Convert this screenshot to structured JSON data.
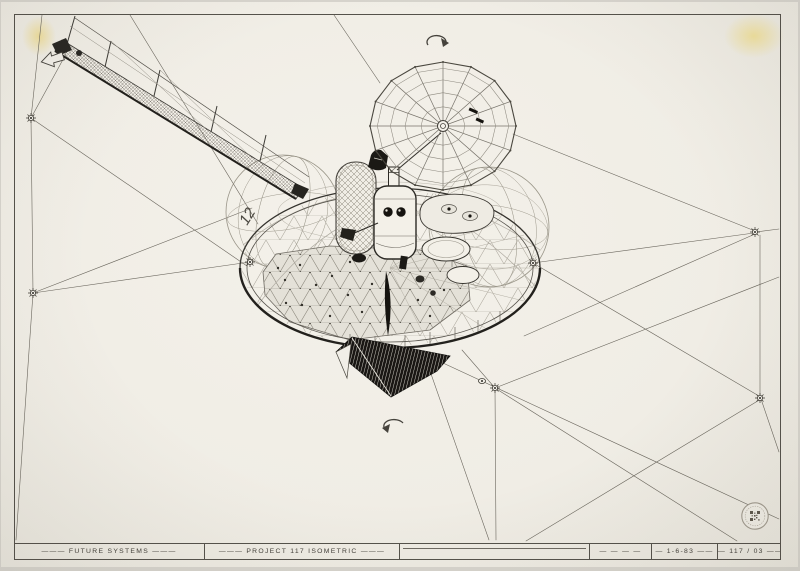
{
  "sheet": {
    "labels": {
      "sphere_marking": "12"
    },
    "title_block": {
      "cells": [
        {
          "id": "firm",
          "label": "——— FUTURE SYSTEMS ———"
        },
        {
          "id": "title",
          "label": "——— PROJECT 117  ISOMETRIC ———"
        },
        {
          "id": "blank",
          "label": ""
        },
        {
          "id": "dashes",
          "label": "— — — —"
        },
        {
          "id": "date",
          "label": "— 1-6-83 ——"
        },
        {
          "id": "number",
          "label": "— 117 / 03 ——"
        }
      ]
    },
    "colors": {
      "paper": "#f1eee7",
      "ink": "#38352f",
      "light_ink": "#8f8b81",
      "tape_stain": "#f0de91",
      "panel_black": "#181613",
      "stamp_ring": "#a09a8e"
    }
  }
}
